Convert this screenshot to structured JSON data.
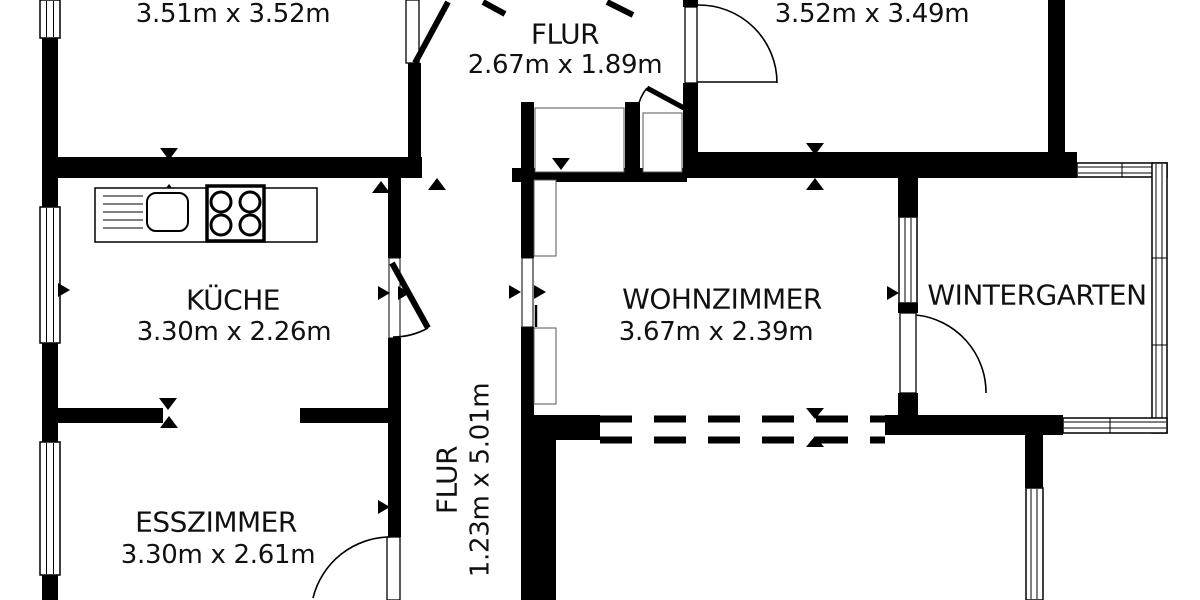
{
  "plan": {
    "colors": {
      "wall": "#000000",
      "background": "#ffffff",
      "text": "#111111"
    },
    "rooms": [
      {
        "id": "room-top-left",
        "label": "",
        "dims": "3.51m x 3.52m"
      },
      {
        "id": "flur-top",
        "label": "FLUR",
        "dims": "2.67m x 1.89m"
      },
      {
        "id": "room-top-right",
        "label": "",
        "dims": "3.52m x 3.49m"
      },
      {
        "id": "kueche",
        "label": "KÜCHE",
        "dims": "3.30m x 2.26m"
      },
      {
        "id": "wohnzimmer",
        "label": "WOHNZIMMER",
        "dims": "3.67m x 2.39m"
      },
      {
        "id": "wintergarten",
        "label": "WINTERGARTEN",
        "dims": ""
      },
      {
        "id": "esszimmer",
        "label": "ESSZIMMER",
        "dims": "3.30m x 2.61m"
      },
      {
        "id": "flur-corridor",
        "label": "FLUR",
        "dims": "1.23m x 5.01m"
      }
    ],
    "fixtures": [
      {
        "icon": "sink-icon",
        "room": "kueche"
      },
      {
        "icon": "stove-icon",
        "room": "kueche"
      }
    ]
  }
}
